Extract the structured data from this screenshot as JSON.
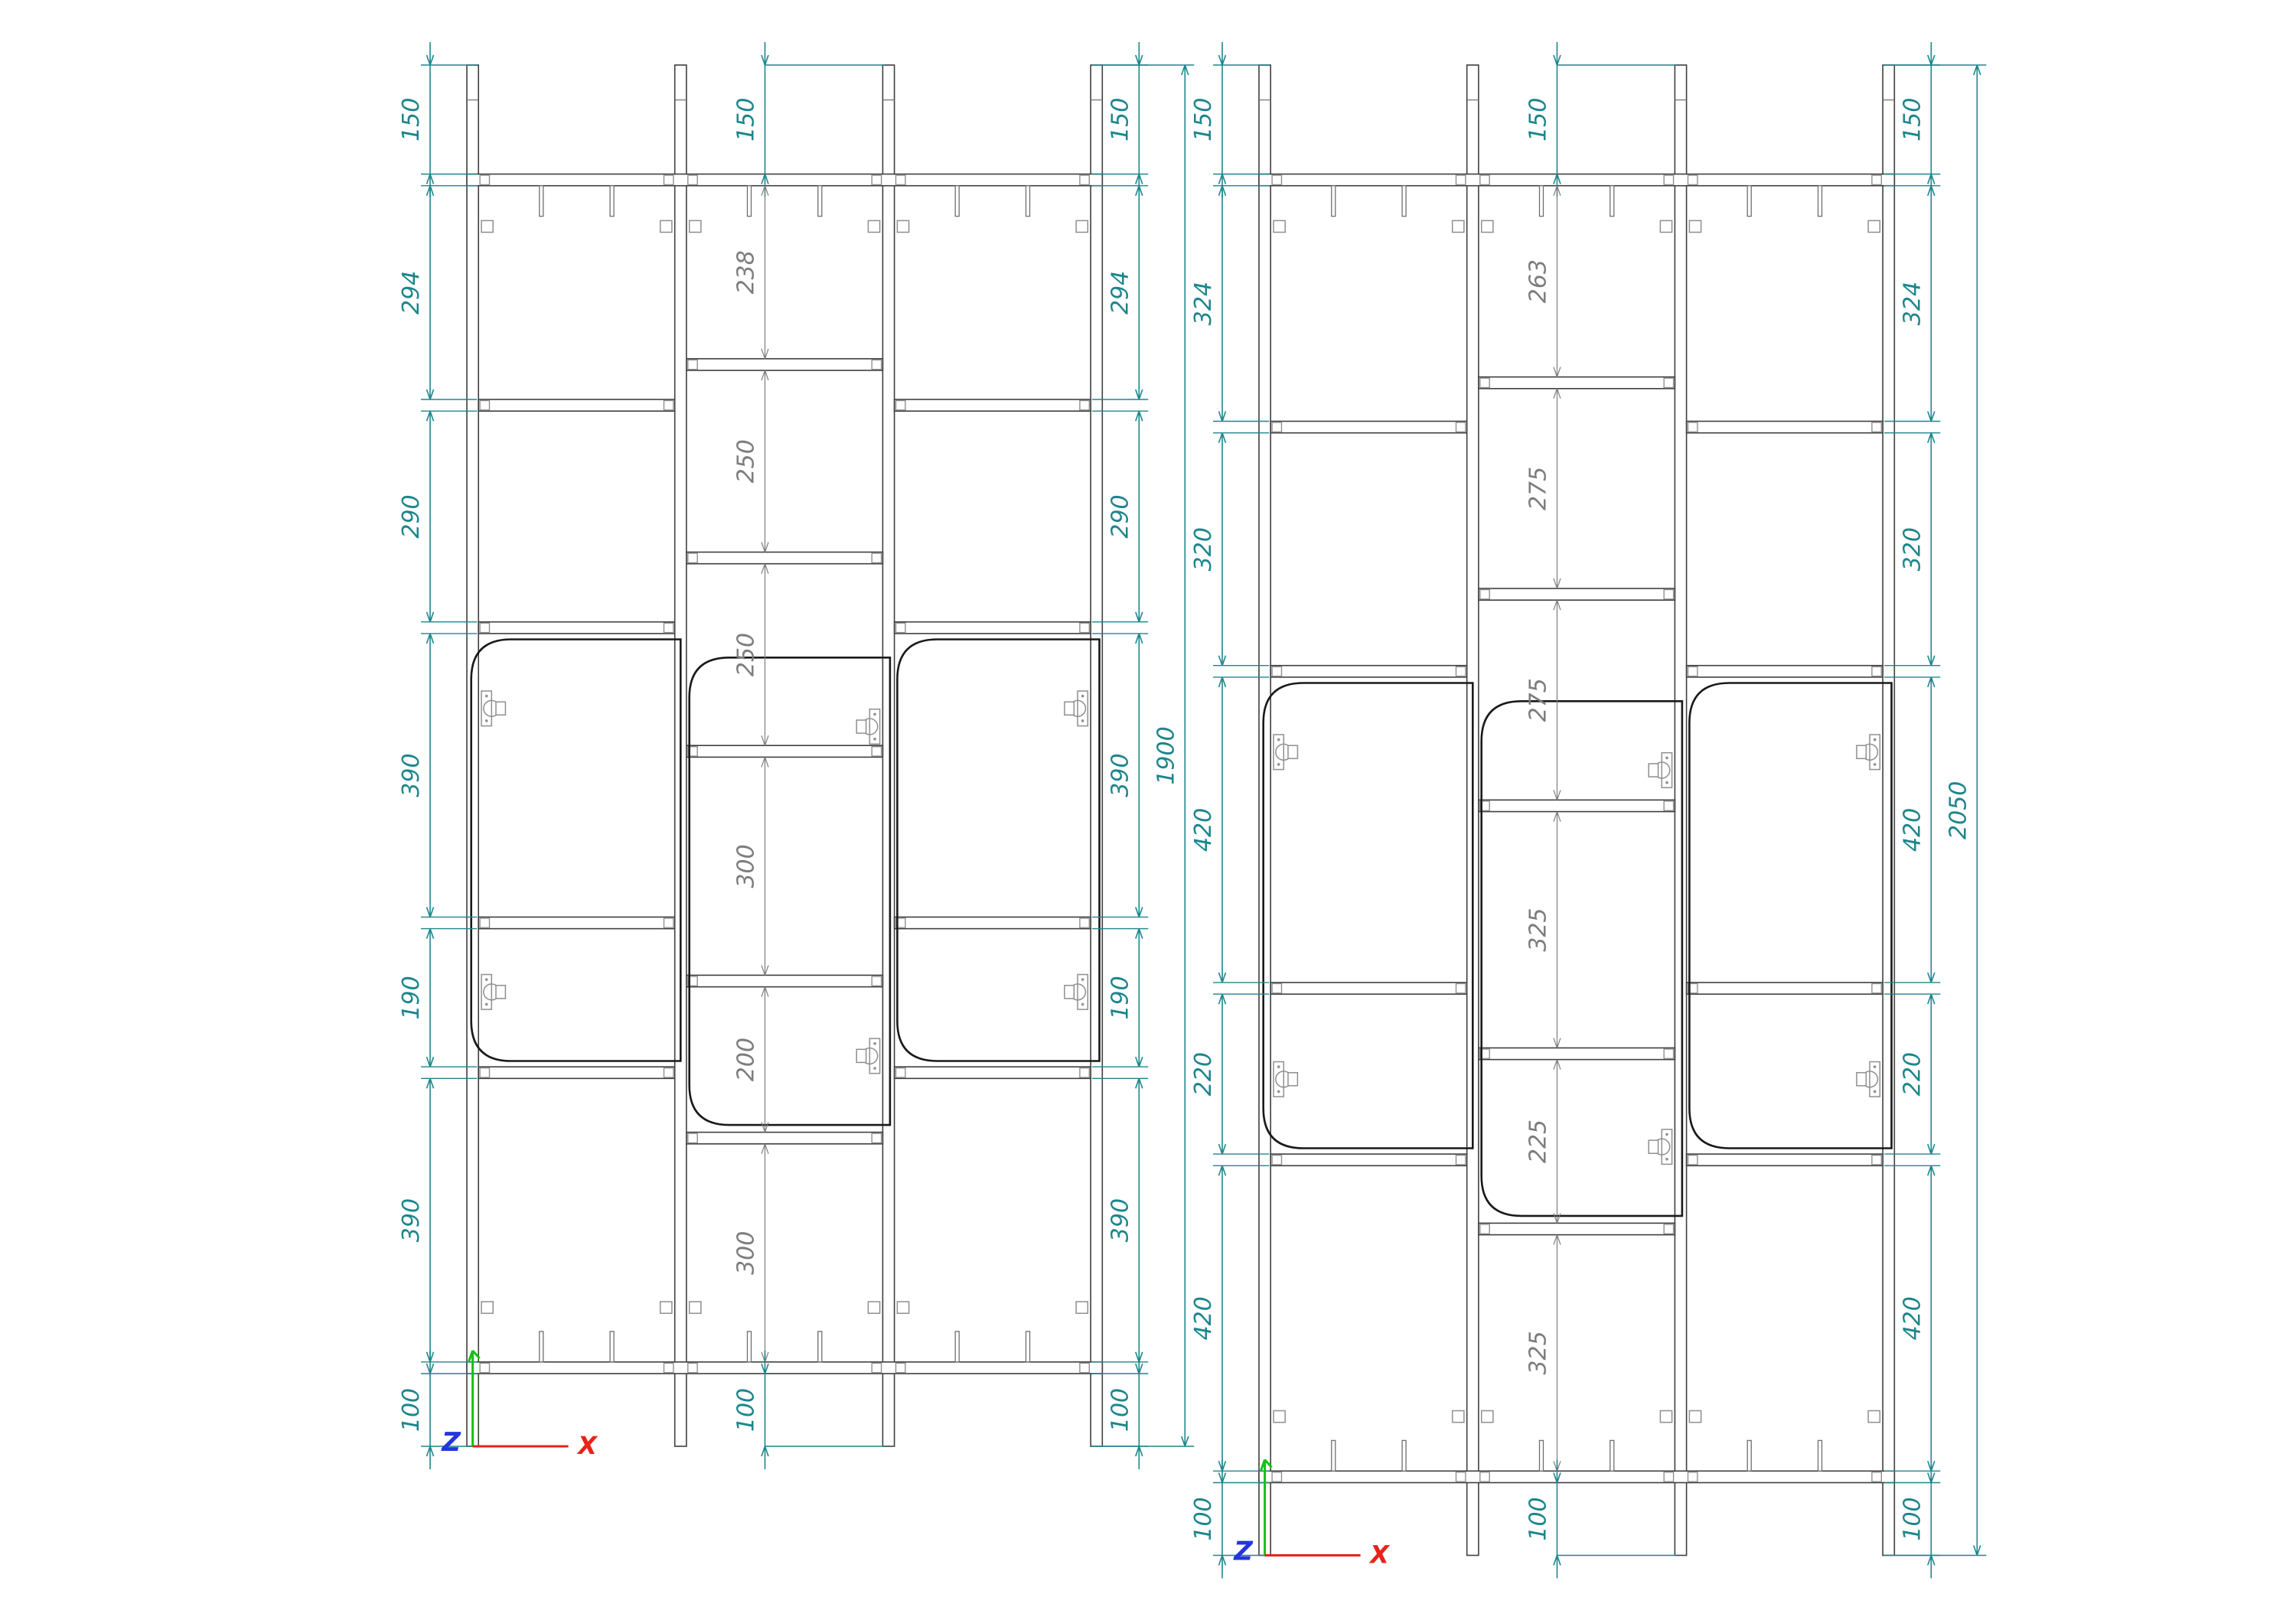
{
  "drawing": {
    "background": "#ffffff",
    "colors": {
      "dim": "#1d868c",
      "inner_dim": "#7d7d7d",
      "line": "#3f3f3f",
      "line_light": "#6e6e6e",
      "door": "#1a1a1a",
      "fitting": "#8f8f8f"
    },
    "axis_triad": {
      "x_label": "X",
      "z_label": "Z",
      "x_color": "#e8231a",
      "y_color": "#12c212",
      "z_color": "#2336dd"
    },
    "views": [
      {
        "id": "cabinet-view-1900",
        "overall_mm": 1900,
        "side_chain_mm": [
          150,
          294,
          290,
          390,
          190,
          390,
          100
        ],
        "center_chain_mm": [
          150,
          238,
          250,
          250,
          300,
          200,
          300,
          100
        ]
      },
      {
        "id": "cabinet-view-2050",
        "overall_mm": 2050,
        "side_chain_mm": [
          150,
          324,
          320,
          420,
          220,
          420,
          100
        ],
        "center_chain_mm": [
          150,
          263,
          275,
          275,
          325,
          225,
          325,
          100
        ]
      }
    ]
  }
}
